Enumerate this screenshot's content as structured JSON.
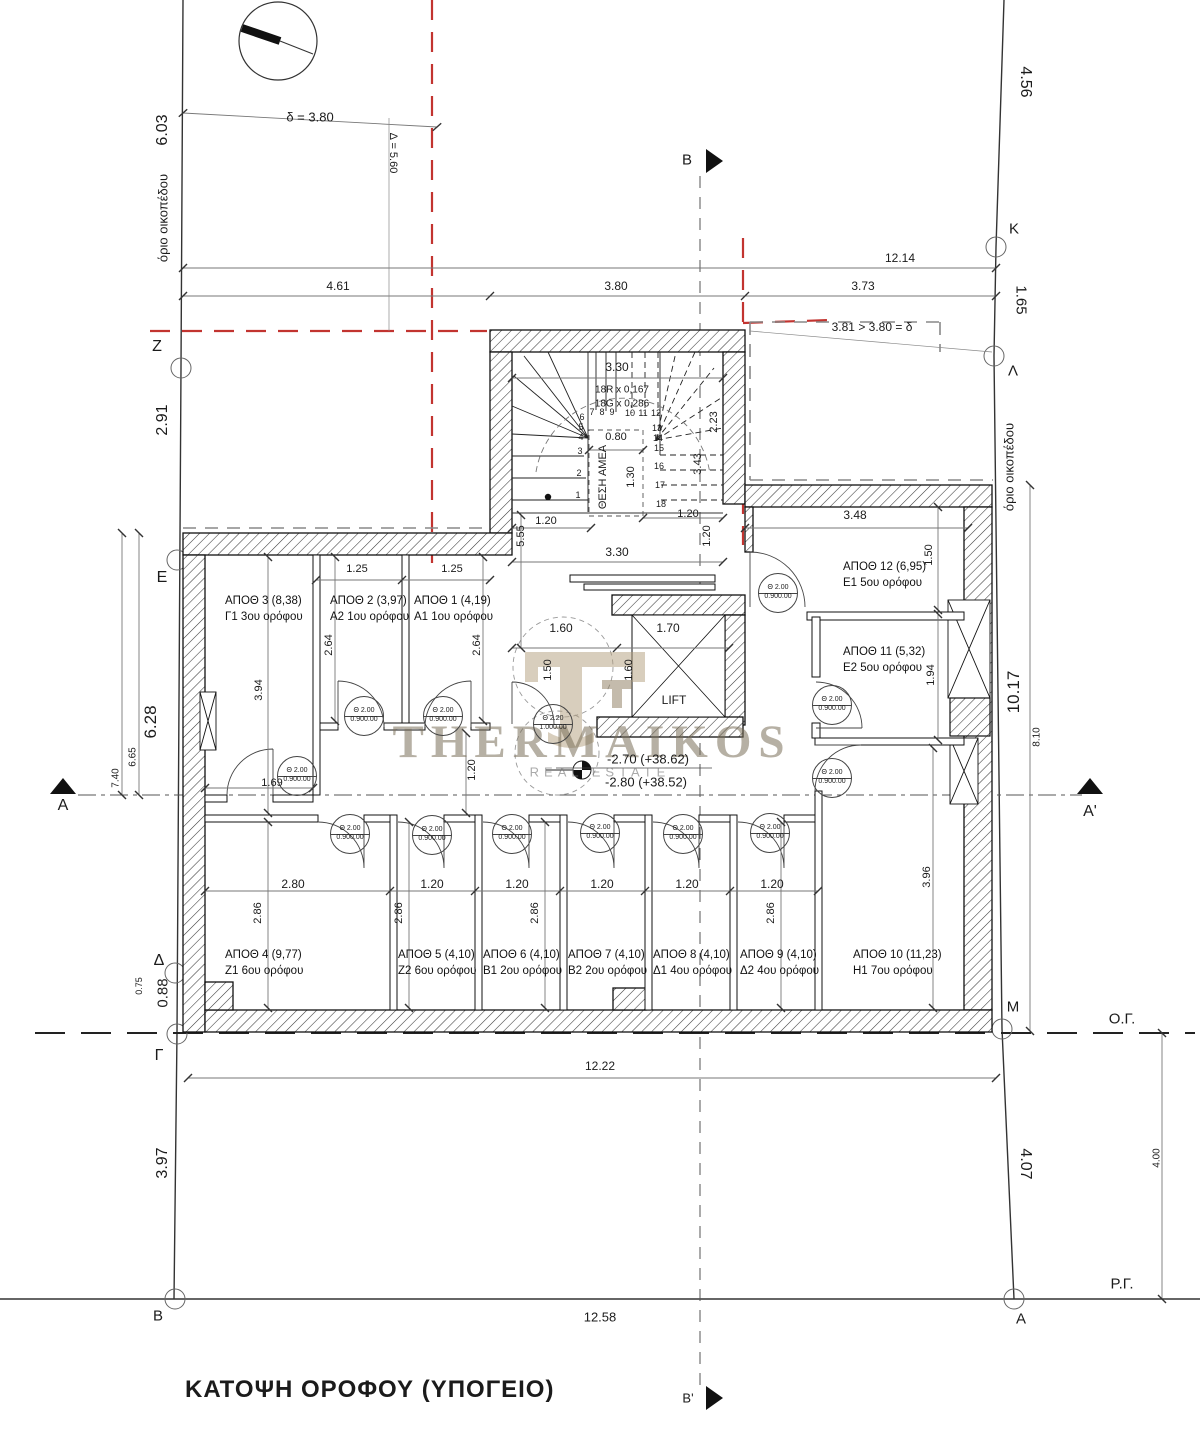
{
  "drawing_title": {
    "text": "ΚΑΤΟΨΗ ΟΡΟΦΟΥ (ΥΠΟΓΕΙΟ)"
  },
  "watermark": {
    "line1": "THERMAIKOS",
    "line2": "REAL ESTATE"
  },
  "colors": {
    "ink": "#1b1b1b",
    "regulation_red": "#c23430",
    "boundary_gray": "#888888",
    "watermark_tan": "#7a705a"
  },
  "rooms": [
    {
      "area_label": "ΑΠΟΘ 3 (8,38)",
      "floor_label": "Γ1 3ου ορόφου",
      "x": 225,
      "y": 594
    },
    {
      "area_label": "ΑΠΟΘ 2 (3,97)",
      "floor_label": "Α2 1ου ορόφου",
      "x": 330,
      "y": 594
    },
    {
      "area_label": "ΑΠΟΘ 1 (4,19)",
      "floor_label": "Α1 1ου ορόφου",
      "x": 414,
      "y": 594
    },
    {
      "area_label": "ΑΠΟΘ 12 (6,95)",
      "floor_label": "Ε1 5ου ορόφου",
      "x": 843,
      "y": 560
    },
    {
      "area_label": "ΑΠΟΘ 11 (5,32)",
      "floor_label": "Ε2 5ου ορόφου",
      "x": 843,
      "y": 645
    },
    {
      "area_label": "ΑΠΟΘ 4 (9,77)",
      "floor_label": "Ζ1 6ου ορόφου",
      "x": 225,
      "y": 948
    },
    {
      "area_label": "ΑΠΟΘ 5 (4,10)",
      "floor_label": "Ζ2 6ου ορόφου",
      "x": 398,
      "y": 948
    },
    {
      "area_label": "ΑΠΟΘ 6 (4,10)",
      "floor_label": "Β1 2ου ορόφου",
      "x": 483,
      "y": 948
    },
    {
      "area_label": "ΑΠΟΘ 7 (4,10)",
      "floor_label": "Β2 2ου ορόφου",
      "x": 568,
      "y": 948
    },
    {
      "area_label": "ΑΠΟΘ 8 (4,10)",
      "floor_label": "Δ1 4ου ορόφου",
      "x": 653,
      "y": 948
    },
    {
      "area_label": "ΑΠΟΘ 9 (4,10)",
      "floor_label": "Δ2 4ου ορόφου",
      "x": 740,
      "y": 948
    },
    {
      "area_label": "ΑΠΟΘ 10 (11,23)",
      "floor_label": "Η1 7ου ορόφου",
      "x": 853,
      "y": 948
    }
  ],
  "door_markers": [
    {
      "top": "Θ 2.00",
      "bottom": "0.900.00",
      "x": 364,
      "y": 716
    },
    {
      "top": "Θ 2.00",
      "bottom": "0.900.00",
      "x": 443,
      "y": 716
    },
    {
      "top": "Θ 2.00",
      "bottom": "0.900.00",
      "x": 297,
      "y": 776
    },
    {
      "top": "Θ 2.20",
      "bottom": "1.000.00",
      "x": 553,
      "y": 724
    },
    {
      "top": "Θ 2.00",
      "bottom": "0.900.00",
      "x": 778,
      "y": 593
    },
    {
      "top": "Θ 2.00",
      "bottom": "0.900.00",
      "x": 832,
      "y": 705
    },
    {
      "top": "Θ 2.00",
      "bottom": "0.900.00",
      "x": 832,
      "y": 778
    },
    {
      "top": "Θ 2.00",
      "bottom": "0.900.00",
      "x": 350,
      "y": 834
    },
    {
      "top": "Θ 2.00",
      "bottom": "0.900.00",
      "x": 432,
      "y": 835
    },
    {
      "top": "Θ 2.00",
      "bottom": "0.900.00",
      "x": 512,
      "y": 834
    },
    {
      "top": "Θ 2.00",
      "bottom": "0.900.00",
      "x": 600,
      "y": 833
    },
    {
      "top": "Θ 2.00",
      "bottom": "0.900.00",
      "x": 683,
      "y": 834
    },
    {
      "top": "Θ 2.00",
      "bottom": "0.900.00",
      "x": 770,
      "y": 833
    }
  ],
  "labels": [
    {
      "n": "dim-left-6-03",
      "text": "6.03",
      "x": 163,
      "y": 130,
      "fs": 16,
      "r": -90
    },
    {
      "n": "label-orio-oikopedou-left",
      "text": "όριο οικοπέδου",
      "x": 163,
      "y": 218,
      "fs": 13,
      "r": -90
    },
    {
      "n": "marker-z",
      "text": "Ζ",
      "x": 157,
      "y": 347,
      "fs": 16
    },
    {
      "n": "dim-left-2-91",
      "text": "2.91",
      "x": 163,
      "y": 420,
      "fs": 16,
      "r": -90
    },
    {
      "n": "marker-e",
      "text": "Ε",
      "x": 162,
      "y": 578,
      "fs": 16
    },
    {
      "n": "dim-left-6-28",
      "text": "6.28",
      "x": 151,
      "y": 722,
      "fs": 17,
      "r": -90
    },
    {
      "n": "dim-left-6-65",
      "text": "6.65",
      "x": 133,
      "y": 757,
      "fs": 10,
      "r": -90
    },
    {
      "n": "dim-left-7-40",
      "text": "7.40",
      "x": 116,
      "y": 778,
      "fs": 10,
      "r": -90
    },
    {
      "n": "section-a-label",
      "text": "Α",
      "x": 63,
      "y": 806,
      "fs": 16
    },
    {
      "n": "marker-d",
      "text": "Δ",
      "x": 159,
      "y": 961,
      "fs": 16
    },
    {
      "n": "dim-left-0-88",
      "text": "0.88",
      "x": 163,
      "y": 993,
      "fs": 15,
      "r": -90
    },
    {
      "n": "dim-left-0-75",
      "text": "0.75",
      "x": 139,
      "y": 986,
      "fs": 9,
      "r": -90
    },
    {
      "n": "marker-g",
      "text": "Γ",
      "x": 159,
      "y": 1056,
      "fs": 16
    },
    {
      "n": "dim-left-3-97",
      "text": "3.97",
      "x": 163,
      "y": 1163,
      "fs": 16,
      "r": -90
    },
    {
      "n": "marker-b-bottom",
      "text": "Β",
      "x": 158,
      "y": 1316,
      "fs": 15
    },
    {
      "n": "dim-right-4-56",
      "text": "4.56",
      "x": 1025,
      "y": 82,
      "fs": 16,
      "r": 90
    },
    {
      "n": "marker-k",
      "text": "Κ",
      "x": 1014,
      "y": 229,
      "fs": 15
    },
    {
      "n": "dim-right-1-65",
      "text": "1.65",
      "x": 1021,
      "y": 300,
      "fs": 15,
      "r": 90
    },
    {
      "n": "marker-l",
      "text": "Λ",
      "x": 1013,
      "y": 371,
      "fs": 15
    },
    {
      "n": "label-orio-oikopedou-right",
      "text": "όριο οικοπέδου",
      "x": 1009,
      "y": 467,
      "fs": 13,
      "r": -90
    },
    {
      "n": "dim-right-10-17",
      "text": "10.17",
      "x": 1014,
      "y": 692,
      "fs": 17,
      "r": -90
    },
    {
      "n": "dim-right-8-10",
      "text": "8.10",
      "x": 1037,
      "y": 737,
      "fs": 10,
      "r": -90
    },
    {
      "n": "section-a-prime-label",
      "text": "Α'",
      "x": 1090,
      "y": 812,
      "fs": 16
    },
    {
      "n": "marker-m",
      "text": "Μ",
      "x": 1013,
      "y": 1007,
      "fs": 15
    },
    {
      "n": "label-og",
      "text": "Ο.Γ.",
      "x": 1122,
      "y": 1019,
      "fs": 15
    },
    {
      "n": "dim-right-4-07",
      "text": "4.07",
      "x": 1025,
      "y": 1164,
      "fs": 16,
      "r": 90
    },
    {
      "n": "dim-right-4-00",
      "text": "4.00",
      "x": 1157,
      "y": 1158,
      "fs": 10,
      "r": -90
    },
    {
      "n": "label-rg",
      "text": "Ρ.Γ.",
      "x": 1122,
      "y": 1284,
      "fs": 15
    },
    {
      "n": "marker-a-bottom",
      "text": "Α",
      "x": 1021,
      "y": 1319,
      "fs": 15
    },
    {
      "n": "dim-delta-3-80",
      "text": "δ = 3.80",
      "x": 310,
      "y": 117,
      "fs": 13
    },
    {
      "n": "dim-delta-5-60",
      "text": "Δ = 5.60",
      "x": 393,
      "y": 153,
      "fs": 11,
      "r": 90
    },
    {
      "n": "dim-top-12-14",
      "text": "12.14",
      "x": 900,
      "y": 258,
      "fs": 12
    },
    {
      "n": "dim-top-4-61",
      "text": "4.61",
      "x": 338,
      "y": 286,
      "fs": 12
    },
    {
      "n": "dim-top-3-80",
      "text": "3.80",
      "x": 616,
      "y": 286,
      "fs": 12
    },
    {
      "n": "dim-top-3-73",
      "text": "3.73",
      "x": 863,
      "y": 286,
      "fs": 12
    },
    {
      "n": "section-b-label",
      "text": "Β",
      "x": 687,
      "y": 160,
      "fs": 15
    },
    {
      "n": "note-3-81",
      "text": "3.81 > 3.80 = δ",
      "x": 872,
      "y": 327,
      "fs": 12
    },
    {
      "n": "dim-stair-3-30-top",
      "text": "3.30",
      "x": 617,
      "y": 367,
      "fs": 12
    },
    {
      "n": "note-stair-risers",
      "text": "18R x 0,167",
      "x": 622,
      "y": 390,
      "fs": 10
    },
    {
      "n": "note-stair-goings",
      "text": "18G x 0,286",
      "x": 622,
      "y": 404,
      "fs": 10
    },
    {
      "n": "stair-step-number",
      "text": "1",
      "x": 578,
      "y": 495,
      "fs": 9
    },
    {
      "n": "stair-step-number",
      "text": "2",
      "x": 579,
      "y": 473,
      "fs": 9
    },
    {
      "n": "stair-step-number",
      "text": "3",
      "x": 580,
      "y": 451,
      "fs": 9
    },
    {
      "n": "stair-step-number",
      "text": "4",
      "x": 581,
      "y": 437,
      "fs": 9
    },
    {
      "n": "stair-step-number",
      "text": "5",
      "x": 581,
      "y": 427,
      "fs": 9
    },
    {
      "n": "stair-step-number",
      "text": "6",
      "x": 582,
      "y": 417,
      "fs": 9
    },
    {
      "n": "stair-step-number",
      "text": "7",
      "x": 592,
      "y": 412,
      "fs": 9
    },
    {
      "n": "stair-step-number",
      "text": "8",
      "x": 602,
      "y": 412,
      "fs": 9
    },
    {
      "n": "stair-step-number",
      "text": "9",
      "x": 612,
      "y": 412,
      "fs": 9
    },
    {
      "n": "stair-step-number",
      "text": "10",
      "x": 630,
      "y": 413,
      "fs": 9
    },
    {
      "n": "stair-step-number",
      "text": "11",
      "x": 643,
      "y": 413,
      "fs": 9
    },
    {
      "n": "stair-step-number",
      "text": "12",
      "x": 656,
      "y": 413,
      "fs": 9
    },
    {
      "n": "stair-step-number",
      "text": "13",
      "x": 657,
      "y": 428,
      "fs": 9
    },
    {
      "n": "stair-step-number",
      "text": "14",
      "x": 658,
      "y": 438,
      "fs": 9
    },
    {
      "n": "stair-step-number",
      "text": "15",
      "x": 659,
      "y": 448,
      "fs": 9
    },
    {
      "n": "stair-step-number",
      "text": "16",
      "x": 659,
      "y": 466,
      "fs": 9
    },
    {
      "n": "stair-step-number",
      "text": "17",
      "x": 660,
      "y": 485,
      "fs": 9
    },
    {
      "n": "stair-step-number",
      "text": "18",
      "x": 661,
      "y": 504,
      "fs": 9
    },
    {
      "n": "dim-stair-0-80",
      "text": "0.80",
      "x": 616,
      "y": 437,
      "fs": 11
    },
    {
      "n": "label-thesi-amea",
      "text": "ΘΕΣΗ ΑΜΕΑ",
      "x": 603,
      "y": 477,
      "fs": 11,
      "r": -90
    },
    {
      "n": "dim-stair-1-30",
      "text": "1.30",
      "x": 631,
      "y": 477,
      "fs": 11,
      "r": -90
    },
    {
      "n": "dim-stair-2-23",
      "text": "2.23",
      "x": 714,
      "y": 422,
      "fs": 11,
      "r": -90
    },
    {
      "n": "dim-stair-3-43",
      "text": "3.43",
      "x": 698,
      "y": 464,
      "fs": 11,
      "r": -90
    },
    {
      "n": "dim-stair-1-20-a",
      "text": "1.20",
      "x": 546,
      "y": 521,
      "fs": 11
    },
    {
      "n": "dim-stair-1-20-b",
      "text": "1.20",
      "x": 688,
      "y": 514,
      "fs": 11
    },
    {
      "n": "dim-stair-5-55",
      "text": "5.55",
      "x": 521,
      "y": 536,
      "fs": 11,
      "r": -90
    },
    {
      "n": "dim-stair-1-20-c",
      "text": "1.20",
      "x": 707,
      "y": 536,
      "fs": 11,
      "r": -90
    },
    {
      "n": "dim-stair-3-30-bottom",
      "text": "3.30",
      "x": 617,
      "y": 552,
      "fs": 12
    },
    {
      "n": "dim-lobby-1-60",
      "text": "1.60",
      "x": 561,
      "y": 628,
      "fs": 12
    },
    {
      "n": "dim-lift-1-70",
      "text": "1.70",
      "x": 668,
      "y": 628,
      "fs": 12
    },
    {
      "n": "dim-lobby-1-50",
      "text": "1.50",
      "x": 548,
      "y": 670,
      "fs": 11,
      "r": -90
    },
    {
      "n": "dim-lobby-1-60-v",
      "text": "1.60",
      "x": 629,
      "y": 670,
      "fs": 11,
      "r": -90
    },
    {
      "n": "label-lift",
      "text": "LIFT",
      "x": 674,
      "y": 700,
      "fs": 12
    },
    {
      "n": "level-upper",
      "text": "-2.70 (+38.62)",
      "x": 648,
      "y": 759,
      "fs": 13
    },
    {
      "n": "level-lower",
      "text": "-2.80 (+38.52)",
      "x": 646,
      "y": 782,
      "fs": 13
    },
    {
      "n": "dim-1-25-a",
      "text": "1.25",
      "x": 357,
      "y": 569,
      "fs": 11
    },
    {
      "n": "dim-1-25-b",
      "text": "1.25",
      "x": 452,
      "y": 569,
      "fs": 11
    },
    {
      "n": "dim-2-64-a",
      "text": "2.64",
      "x": 329,
      "y": 645,
      "fs": 11,
      "r": -90
    },
    {
      "n": "dim-2-64-b",
      "text": "2.64",
      "x": 477,
      "y": 645,
      "fs": 11,
      "r": -90
    },
    {
      "n": "dim-3-94",
      "text": "3.94",
      "x": 259,
      "y": 690,
      "fs": 11,
      "r": -90
    },
    {
      "n": "dim-1-69",
      "text": "1.69",
      "x": 272,
      "y": 783,
      "fs": 11
    },
    {
      "n": "dim-corridor-1-20",
      "text": "1.20",
      "x": 472,
      "y": 770,
      "fs": 11,
      "r": -90
    },
    {
      "n": "dim-3-48",
      "text": "3.48",
      "x": 855,
      "y": 515,
      "fs": 12
    },
    {
      "n": "dim-1-50",
      "text": "1.50",
      "x": 929,
      "y": 555,
      "fs": 11,
      "r": -90
    },
    {
      "n": "dim-1-94",
      "text": "1.94",
      "x": 931,
      "y": 675,
      "fs": 11,
      "r": -90
    },
    {
      "n": "dim-2-80",
      "text": "2.80",
      "x": 293,
      "y": 884,
      "fs": 12
    },
    {
      "n": "dim-1-20-z2",
      "text": "1.20",
      "x": 432,
      "y": 884,
      "fs": 12
    },
    {
      "n": "dim-1-20-b1",
      "text": "1.20",
      "x": 517,
      "y": 884,
      "fs": 12
    },
    {
      "n": "dim-1-20-b2",
      "text": "1.20",
      "x": 602,
      "y": 884,
      "fs": 12
    },
    {
      "n": "dim-1-20-d1",
      "text": "1.20",
      "x": 687,
      "y": 884,
      "fs": 12
    },
    {
      "n": "dim-1-20-d2",
      "text": "1.20",
      "x": 772,
      "y": 884,
      "fs": 12
    },
    {
      "n": "dim-2-86-a",
      "text": "2.86",
      "x": 258,
      "y": 913,
      "fs": 11,
      "r": -90
    },
    {
      "n": "dim-2-86-b",
      "text": "2.86",
      "x": 399,
      "y": 913,
      "fs": 11,
      "r": -90
    },
    {
      "n": "dim-2-86-c",
      "text": "2.86",
      "x": 535,
      "y": 913,
      "fs": 11,
      "r": -90
    },
    {
      "n": "dim-2-86-d",
      "text": "2.86",
      "x": 771,
      "y": 913,
      "fs": 11,
      "r": -90
    },
    {
      "n": "dim-3-96",
      "text": "3.96",
      "x": 927,
      "y": 877,
      "fs": 11,
      "r": -90
    },
    {
      "n": "dim-12-22",
      "text": "12.22",
      "x": 600,
      "y": 1066,
      "fs": 12
    },
    {
      "n": "dim-12-58",
      "text": "12.58",
      "x": 600,
      "y": 1317,
      "fs": 13
    },
    {
      "n": "section-b-prime-label",
      "text": "Β'",
      "x": 688,
      "y": 1398,
      "fs": 13
    }
  ]
}
